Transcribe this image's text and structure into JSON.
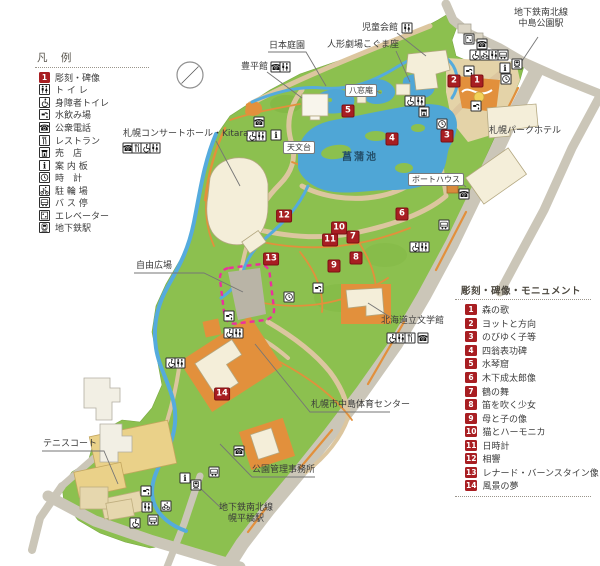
{
  "legend": {
    "title": "凡 例",
    "items": [
      {
        "icon": "marker",
        "label": "彫刻・碑像"
      },
      {
        "icon": "toilet",
        "label": "ト イ レ"
      },
      {
        "icon": "wheelchair",
        "label": "身障者トイレ"
      },
      {
        "icon": "water",
        "label": "水飲み場"
      },
      {
        "icon": "phone",
        "label": "公衆電話"
      },
      {
        "icon": "restaurant",
        "label": "レストラン"
      },
      {
        "icon": "shop",
        "label": "売　店"
      },
      {
        "icon": "info",
        "label": "案 内 板"
      },
      {
        "icon": "clock",
        "label": "時　計"
      },
      {
        "icon": "bicycle",
        "label": "駐 輪 場"
      },
      {
        "icon": "bus",
        "label": "バ ス 停"
      },
      {
        "icon": "elevator",
        "label": "エレベーター"
      },
      {
        "icon": "subway",
        "label": "地下鉄駅"
      }
    ]
  },
  "monuments": {
    "title": "彫刻・碑像・モニュメント",
    "items": [
      {
        "num": "1",
        "label": "森の歌"
      },
      {
        "num": "2",
        "label": "ヨットと方向"
      },
      {
        "num": "3",
        "label": "のびゆく子等"
      },
      {
        "num": "4",
        "label": "四翁表功碑"
      },
      {
        "num": "5",
        "label": "水琴窟"
      },
      {
        "num": "6",
        "label": "木下成太郎像"
      },
      {
        "num": "7",
        "label": "鶴の舞"
      },
      {
        "num": "8",
        "label": "笛を吹く少女"
      },
      {
        "num": "9",
        "label": "母と子の像"
      },
      {
        "num": "10",
        "label": "猫とハーモニカ"
      },
      {
        "num": "11",
        "label": "日時計"
      },
      {
        "num": "12",
        "label": "相響"
      },
      {
        "num": "13",
        "label": "レナード・バーンスタイン像"
      },
      {
        "num": "14",
        "label": "風景の夢"
      }
    ]
  },
  "map": {
    "markers": [
      {
        "num": "1",
        "x": 477,
        "y": 81
      },
      {
        "num": "2",
        "x": 454,
        "y": 81
      },
      {
        "num": "3",
        "x": 447,
        "y": 136
      },
      {
        "num": "4",
        "x": 392,
        "y": 139
      },
      {
        "num": "5",
        "x": 348,
        "y": 111
      },
      {
        "num": "6",
        "x": 402,
        "y": 214
      },
      {
        "num": "7",
        "x": 353,
        "y": 237
      },
      {
        "num": "8",
        "x": 356,
        "y": 258
      },
      {
        "num": "9",
        "x": 334,
        "y": 266
      },
      {
        "num": "10",
        "x": 339,
        "y": 228
      },
      {
        "num": "11",
        "x": 330,
        "y": 240
      },
      {
        "num": "12",
        "x": 284,
        "y": 216
      },
      {
        "num": "13",
        "x": 271,
        "y": 259
      },
      {
        "num": "14",
        "x": 222,
        "y": 394
      }
    ],
    "icons": [
      {
        "type": "toilet",
        "x": 407,
        "y": 28
      },
      {
        "type": "elevator",
        "x": 469,
        "y": 39
      },
      {
        "type": "phone",
        "x": 482,
        "y": 44
      },
      {
        "type": "wheelchair",
        "x": 475,
        "y": 55
      },
      {
        "type": "bicycle",
        "x": 485,
        "y": 55
      },
      {
        "type": "toilet",
        "x": 494,
        "y": 55
      },
      {
        "type": "bus",
        "x": 503,
        "y": 55
      },
      {
        "type": "info",
        "x": 505,
        "y": 68
      },
      {
        "type": "subway",
        "x": 517,
        "y": 64
      },
      {
        "type": "clock",
        "x": 506,
        "y": 79
      },
      {
        "type": "water",
        "x": 469,
        "y": 71
      },
      {
        "type": "water",
        "x": 476,
        "y": 106
      },
      {
        "type": "phone",
        "x": 276,
        "y": 67
      },
      {
        "type": "toilet",
        "x": 285,
        "y": 67
      },
      {
        "type": "phone",
        "x": 128,
        "y": 148
      },
      {
        "type": "restaurant",
        "x": 137,
        "y": 148
      },
      {
        "type": "wheelchair",
        "x": 146,
        "y": 148
      },
      {
        "type": "toilet",
        "x": 155,
        "y": 148
      },
      {
        "type": "wheelchair",
        "x": 410,
        "y": 101
      },
      {
        "type": "toilet",
        "x": 420,
        "y": 101
      },
      {
        "type": "shop",
        "x": 424,
        "y": 112
      },
      {
        "type": "clock",
        "x": 442,
        "y": 124
      },
      {
        "type": "phone",
        "x": 259,
        "y": 122
      },
      {
        "type": "wheelchair",
        "x": 252,
        "y": 136
      },
      {
        "type": "toilet",
        "x": 261,
        "y": 136
      },
      {
        "type": "info",
        "x": 276,
        "y": 135
      },
      {
        "type": "phone",
        "x": 464,
        "y": 194
      },
      {
        "type": "bus",
        "x": 444,
        "y": 225
      },
      {
        "type": "wheelchair",
        "x": 415,
        "y": 247
      },
      {
        "type": "toilet",
        "x": 424,
        "y": 247
      },
      {
        "type": "water",
        "x": 318,
        "y": 288
      },
      {
        "type": "clock",
        "x": 289,
        "y": 297
      },
      {
        "type": "water",
        "x": 229,
        "y": 316
      },
      {
        "type": "wheelchair",
        "x": 229,
        "y": 333
      },
      {
        "type": "toilet",
        "x": 238,
        "y": 333
      },
      {
        "type": "wheelchair",
        "x": 171,
        "y": 363
      },
      {
        "type": "toilet",
        "x": 180,
        "y": 363
      },
      {
        "type": "water",
        "x": 146,
        "y": 491
      },
      {
        "type": "toilet",
        "x": 147,
        "y": 507
      },
      {
        "type": "bicycle",
        "x": 166,
        "y": 506
      },
      {
        "type": "bus",
        "x": 153,
        "y": 520
      },
      {
        "type": "wheelchair",
        "x": 135,
        "y": 523
      },
      {
        "type": "info",
        "x": 185,
        "y": 478
      },
      {
        "type": "subway",
        "x": 196,
        "y": 485
      },
      {
        "type": "bus",
        "x": 214,
        "y": 472
      },
      {
        "type": "phone",
        "x": 239,
        "y": 451
      },
      {
        "type": "wheelchair",
        "x": 392,
        "y": 338
      },
      {
        "type": "toilet",
        "x": 401,
        "y": 338
      },
      {
        "type": "restaurant",
        "x": 410,
        "y": 338
      },
      {
        "type": "phone",
        "x": 423,
        "y": 338
      }
    ],
    "labels": [
      {
        "text": "児童会館",
        "x": 362,
        "y": 23
      },
      {
        "text": "人形劇場こぐま座",
        "x": 327,
        "y": 40
      },
      {
        "text": "日本庭園",
        "x": 269,
        "y": 41
      },
      {
        "text": "豊平館",
        "x": 241,
        "y": 62
      },
      {
        "text": "八窓庵",
        "x": 345,
        "y": 84,
        "box": true
      },
      {
        "lines": [
          "地下鉄南北線",
          "中島公園駅"
        ],
        "x": 514,
        "y": 8,
        "center": true
      },
      {
        "text": "札幌パークホテル",
        "x": 489,
        "y": 126
      },
      {
        "text": "札幌コンサートホール・Kitara",
        "x": 123,
        "y": 129
      },
      {
        "text": "天文台",
        "x": 283,
        "y": 141,
        "box": true
      },
      {
        "text": "菖蒲池",
        "x": 342,
        "y": 153,
        "cls": "pond"
      },
      {
        "text": "ボートハウス",
        "x": 408,
        "y": 173,
        "box": true
      },
      {
        "text": "自由広場",
        "x": 136,
        "y": 261
      },
      {
        "text": "北海道立文学館",
        "x": 381,
        "y": 316
      },
      {
        "text": "札幌市中島体育センター",
        "x": 311,
        "y": 400
      },
      {
        "text": "テニスコート",
        "x": 43,
        "y": 439
      },
      {
        "text": "公園管理事務所",
        "x": 252,
        "y": 465
      },
      {
        "lines": [
          "地下鉄南北線",
          "幌平橋駅"
        ],
        "x": 219,
        "y": 503,
        "center": true
      }
    ]
  },
  "colors": {
    "park_green": "#8cc04f",
    "pond_blue": "#4fa6d6",
    "stream_blue": "#55abdd",
    "path_tan": "#dcc69f",
    "road_gray": "#cbc6b8",
    "accent_orange": "#e2903c",
    "building_cream": "#f4eed9",
    "marker_red": "#a81e22",
    "plaza_pink": "#ec2f9e"
  }
}
